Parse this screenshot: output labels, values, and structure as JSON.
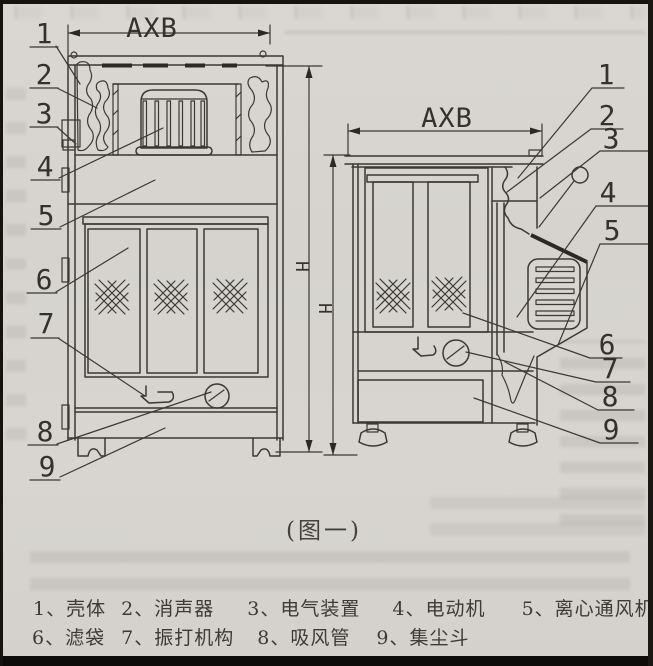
{
  "figure": {
    "caption": "(图一)",
    "views": {
      "front": {
        "width_dim_label": "AXB",
        "height_dim_label": "H",
        "callouts": [
          "1",
          "2",
          "3",
          "4",
          "5",
          "6",
          "7",
          "8",
          "9"
        ]
      },
      "side": {
        "width_dim_label": "AXB",
        "height_dim_label": "H",
        "callouts": [
          "1",
          "2",
          "3",
          "4",
          "5",
          "6",
          "7",
          "8",
          "9"
        ]
      }
    }
  },
  "legend": {
    "row1": [
      "1、壳体",
      "2、消声器",
      "3、电气装置",
      "4、电动机",
      "5、离心通风机"
    ],
    "row2": [
      "6、滤袋",
      "7、振打机构",
      "8、吸风管",
      "9、集尘斗"
    ]
  },
  "colors": {
    "paper": "#d7d4cf",
    "ink": "#3b3835",
    "frame_black": "#151210"
  }
}
